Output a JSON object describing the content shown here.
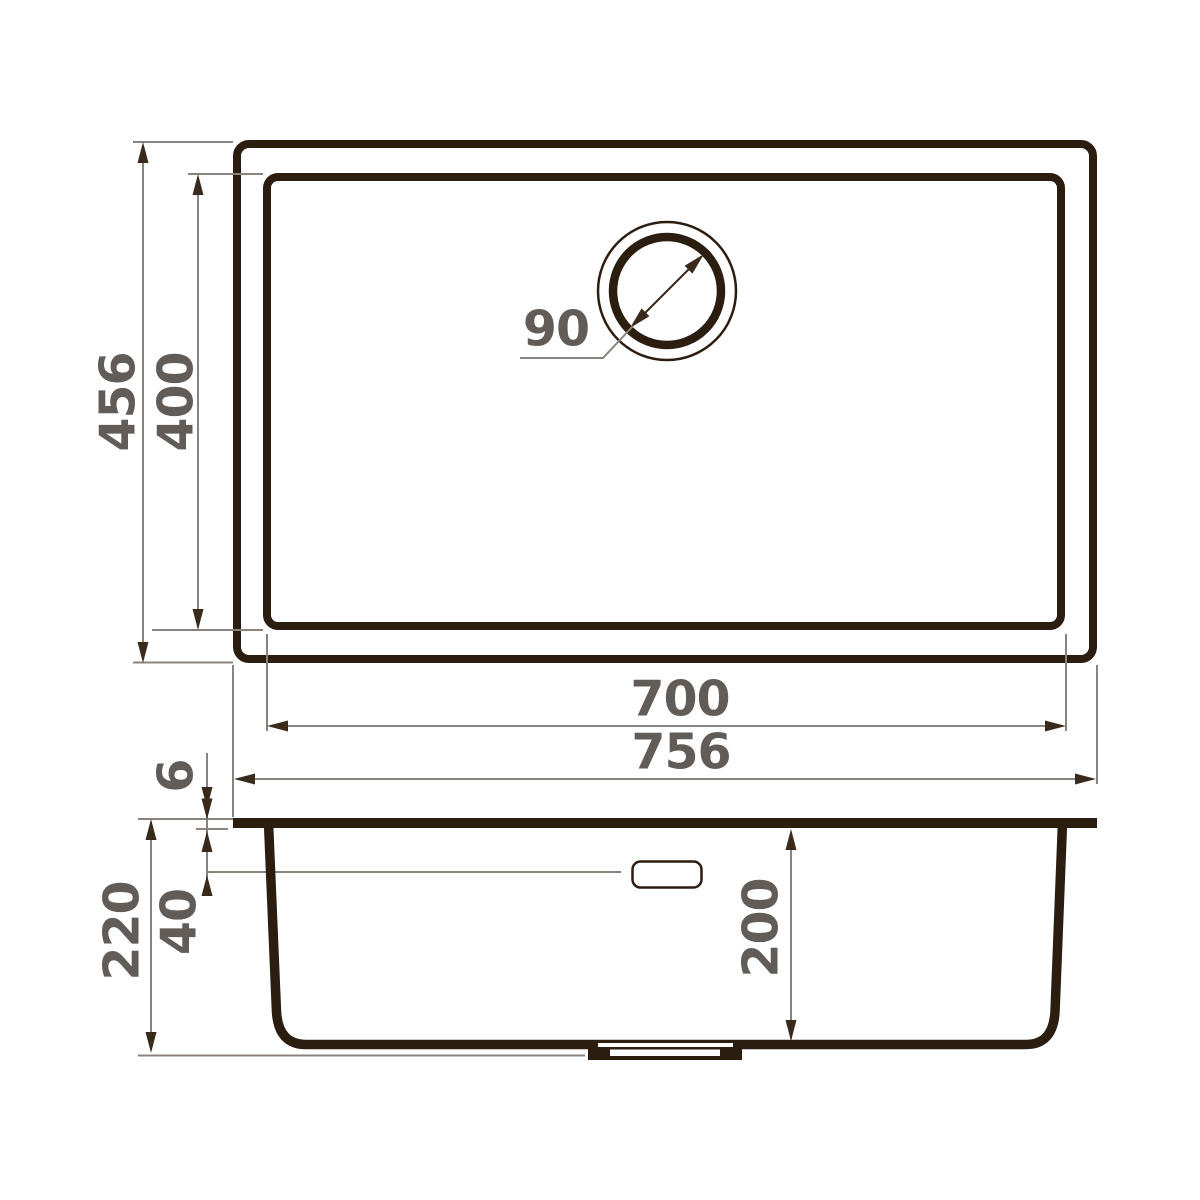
{
  "drawing": {
    "top_view": {
      "overall_height_mm": "456",
      "inner_height_mm": "400",
      "drain_diameter_mm": "90",
      "inner_width_mm": "700",
      "overall_width_mm": "756"
    },
    "side_view": {
      "rim_thickness_mm": "6",
      "overflow_drop_mm": "40",
      "overall_depth_mm": "220",
      "bowl_depth_mm": "200"
    }
  },
  "colors": {
    "outline": "#2b1d10",
    "dimension_line": "#8a837d",
    "arrow": "#3a2a1c",
    "label_text": "#615c57",
    "background": "#ffffff"
  }
}
